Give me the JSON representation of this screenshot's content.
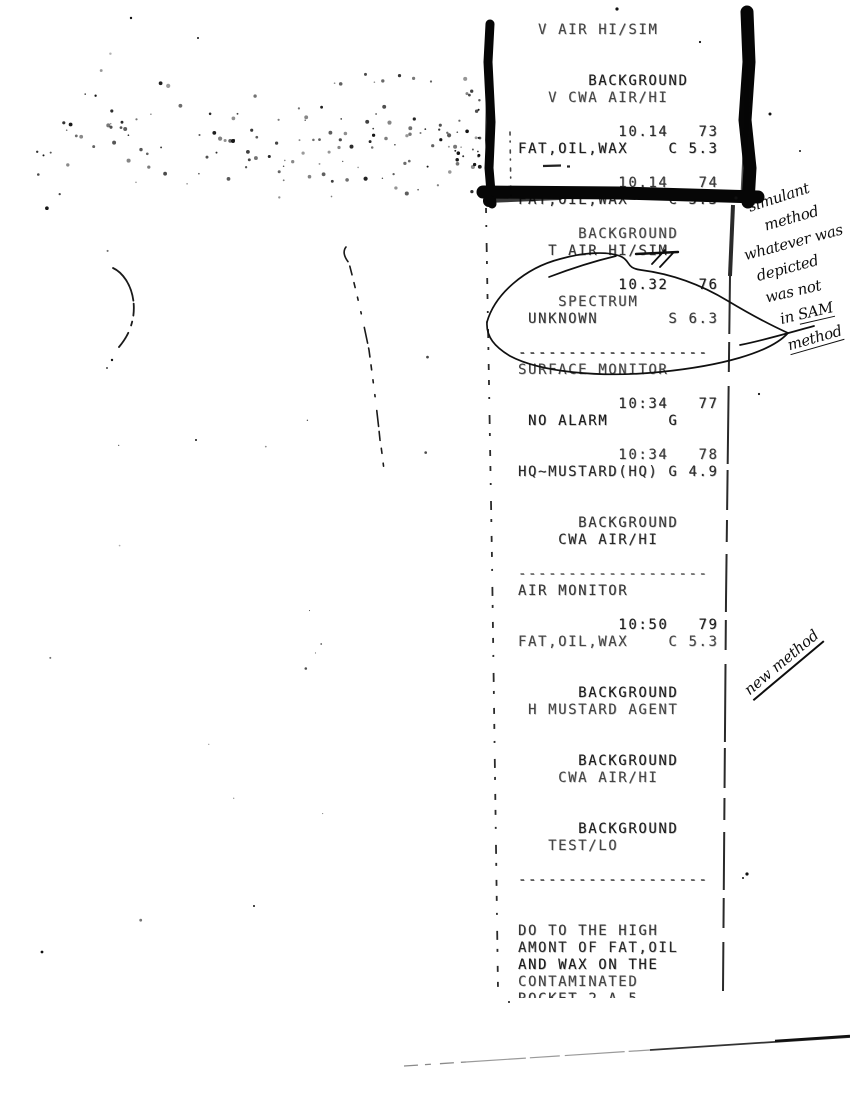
{
  "document_type": "scanned chemical agent monitor printout with handwritten annotations",
  "ink_color": "#1c1c1c",
  "paper_color": "#ffffff",
  "receipt": {
    "lines": [
      "  V AIR HI/SIM",
      "",
      "",
      "       BACKGROUND",
      "   V CWA AIR/HI",
      "",
      "          10.14   73",
      "FAT,OIL,WAX    C 5.3",
      "",
      "          10.14   74",
      "FAT,OIL,WAX    C 5.3",
      "",
      "      BACKGROUND",
      "   T AIR HI/SIM",
      "",
      "          10.32   76",
      "    SPECTRUM",
      " UNKNOWN       S 6.3",
      "",
      "-------------------",
      "SURFACE MONITOR",
      "",
      "          10:34   77",
      " NO ALARM      G",
      "",
      "          10:34   78",
      "HQ~MUSTARD(HQ) G 4.9",
      "",
      "",
      "      BACKGROUND",
      "    CWA AIR/HI",
      "",
      "-------------------",
      "AIR MONITOR",
      "",
      "          10:50   79",
      "FAT,OIL,WAX    C 5.3",
      "",
      "",
      "      BACKGROUND",
      " H MUSTARD AGENT",
      "",
      "",
      "      BACKGROUND",
      "    CWA AIR/HI",
      "",
      "",
      "      BACKGROUND",
      "   TEST/LO",
      "",
      "-------------------",
      "",
      "",
      "DO TO THE HIGH",
      "AMONT OF FAT,OIL",
      "AND WAX ON THE",
      "CONTAMINATED",
      "ROCKET 2 A 5"
    ]
  },
  "handwritten": {
    "side_note_lines": [
      {
        "text": "simulant",
        "underline": ""
      },
      {
        "text": "method",
        "underline": ""
      },
      {
        "text": "whatever was",
        "underline": ""
      },
      {
        "text": "depicted",
        "underline": ""
      },
      {
        "text": "was not",
        "underline": ""
      },
      {
        "text": "in SAM",
        "underline": "SAM"
      },
      {
        "text": "method",
        "underline": "full"
      }
    ],
    "new_method": {
      "text": "new method"
    }
  }
}
